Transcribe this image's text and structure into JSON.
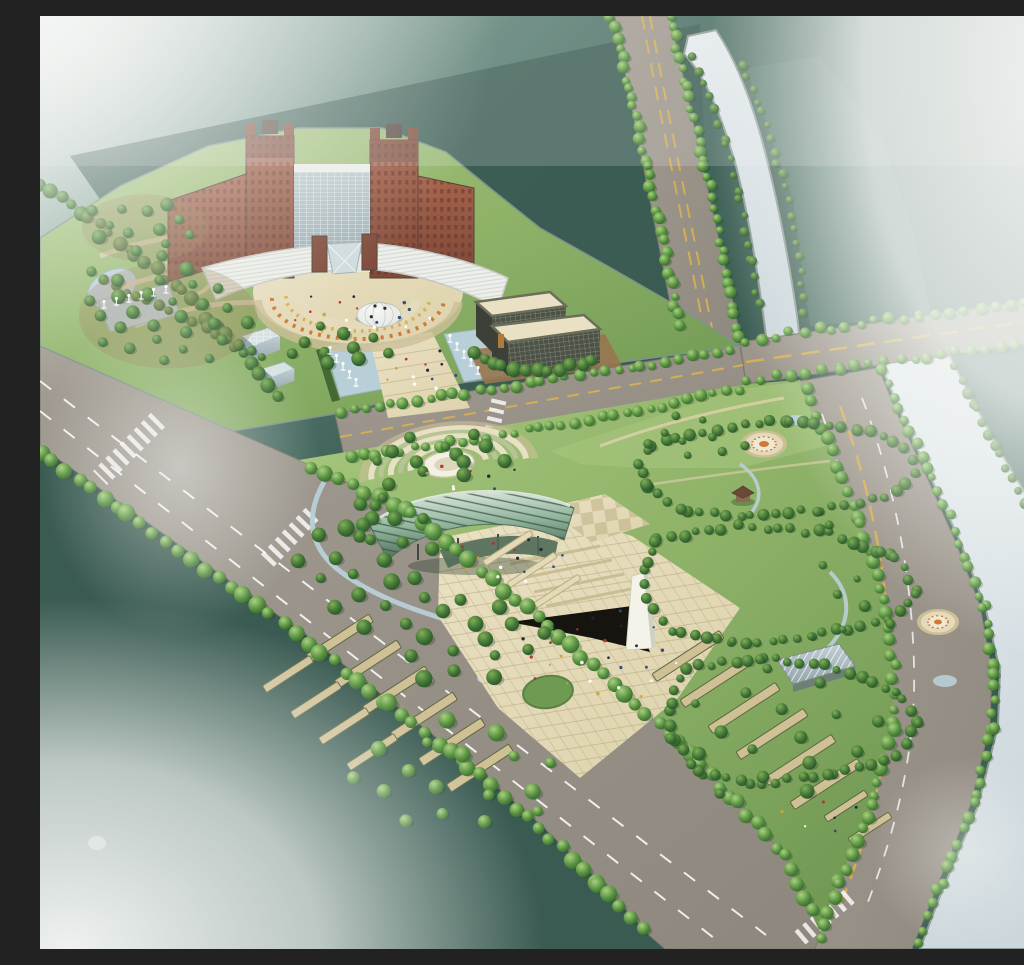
{
  "meta": {
    "width": 1024,
    "height": 933,
    "kind": "architectural-aerial-rendering"
  },
  "scene": {
    "description": "Bird's-eye rendering of a riverside civic campus with a red-brick high-rise, crescent forecourt with dome, office block, tree-lined roads, a bridge over a river, and a large memorial park with amphitheater canopy, obelisk plaza and lawns",
    "elements": [
      "main-building",
      "crescent-forecourt",
      "dome",
      "office-building",
      "glass-cubes",
      "fountain-channels",
      "north-avenue",
      "central-road",
      "boulevard",
      "bridge",
      "riverside-road",
      "river",
      "memorial-park",
      "amphitheater",
      "canopy-pavilion",
      "monument-obelisk",
      "circular-lawn",
      "greenhouse-pavilion",
      "garden-medallions",
      "gazebo",
      "streams",
      "tree-rows",
      "pedestrians"
    ]
  },
  "palette": {
    "bgTop": "#e9efec",
    "water": "#43665c",
    "waterDark": "#3a5b52",
    "farBank": "#4e7166",
    "river": "#ccd7dc",
    "riverLight": "#e7edf0",
    "bank": "#8d9b94",
    "road": "#a39c92",
    "roadDark": "#8f887e",
    "roadEdge": "#7e786e",
    "laneYellow": "#d2ae54",
    "laneWhite": "#ffffff",
    "lawn": "#8db167",
    "lawnDark": "#6d9551",
    "lawnLight": "#a8c67e",
    "plaza": "#ddd2ab",
    "plazaLight": "#eae1c4",
    "plazaLine": "#b7a77d",
    "stripTan": "#cfc096",
    "stripLight": "#e4dab6",
    "stripEdge": "#5c6840",
    "soil": "#987650",
    "brick": "#a8634b",
    "brickDark": "#7f4938",
    "roofDark": "#53423a",
    "white": "#eceee9",
    "roofGray": "#c6c9c4",
    "glass": "#c2cfd3",
    "glassDark": "#93a6ac",
    "curtain": "#4d5247",
    "curtainLine": "#c2c6b8",
    "dome": "#e8eae6",
    "domeShade": "#b9bfba",
    "canopy": "#8fb29a",
    "canopyDark": "#4f6a58",
    "canopyLight": "#e6eee7",
    "stream": "#b9cfd8",
    "obelisk": "#f4f3ea",
    "shadow": "#15140f",
    "treeShadow": "#1d3a22",
    "mist": "#f4f6f4",
    "treeBrightA": "#a9d17f",
    "treeBrightB": "#579140",
    "treeBrightC": "#2f5c2b",
    "treeDarkA": "#7fae58",
    "treeDarkB": "#417436",
    "treeDarkC": "#224a23",
    "people": [
      "#1e2430",
      "#ffffff",
      "#b03030",
      "#2a4a7a",
      "#caa23c"
    ]
  },
  "vegetation": {
    "rows": [
      {
        "name": "avenue-north-left",
        "points": [
          [
            571,
            0
          ],
          [
            589,
            70
          ],
          [
            607,
            150
          ],
          [
            625,
            235
          ],
          [
            641,
            318
          ]
        ],
        "step": 11,
        "r": 5,
        "variant": "bright"
      },
      {
        "name": "avenue-north-right",
        "points": [
          [
            629,
            0
          ],
          [
            647,
            70
          ],
          [
            665,
            150
          ],
          [
            683,
            235
          ],
          [
            699,
            322
          ]
        ],
        "step": 11,
        "r": 5,
        "variant": "bright"
      },
      {
        "name": "river-west-bank",
        "points": [
          [
            652,
            40
          ],
          [
            668,
            80
          ],
          [
            686,
            130
          ],
          [
            700,
            185
          ],
          [
            712,
            245
          ],
          [
            720,
            300
          ]
        ],
        "step": 15,
        "r": 4,
        "variant": "dark"
      },
      {
        "name": "river-east-bank",
        "points": [
          [
            702,
            50
          ],
          [
            722,
            95
          ],
          [
            738,
            145
          ],
          [
            750,
            200
          ],
          [
            760,
            255
          ],
          [
            766,
            305
          ]
        ],
        "step": 14,
        "r": 4,
        "variant": "dark"
      },
      {
        "name": "bridge-north",
        "points": [
          [
            706,
            324
          ],
          [
            790,
            312
          ],
          [
            880,
            300
          ],
          [
            970,
            288
          ],
          [
            1020,
            282
          ]
        ],
        "step": 15,
        "r": 5,
        "variant": "bright"
      },
      {
        "name": "bridge-south",
        "points": [
          [
            708,
            364
          ],
          [
            800,
            352
          ],
          [
            900,
            339
          ],
          [
            1000,
            326
          ],
          [
            1022,
            323
          ]
        ],
        "step": 15,
        "r": 5,
        "variant": "bright"
      },
      {
        "name": "central-road-north",
        "points": [
          [
            300,
            396
          ],
          [
            400,
            381
          ],
          [
            500,
            366
          ],
          [
            600,
            350
          ],
          [
            690,
            334
          ]
        ],
        "step": 13,
        "r": 5,
        "variant": "bright"
      },
      {
        "name": "central-road-south",
        "points": [
          [
            310,
            442
          ],
          [
            410,
            427
          ],
          [
            510,
            411
          ],
          [
            610,
            394
          ],
          [
            700,
            372
          ]
        ],
        "step": 13,
        "r": 5,
        "variant": "bright"
      },
      {
        "name": "campus-west-shore",
        "points": [
          [
            0,
            168
          ],
          [
            48,
            202
          ],
          [
            96,
            238
          ],
          [
            140,
            274
          ],
          [
            178,
            310
          ],
          [
            212,
            348
          ],
          [
            240,
            382
          ]
        ],
        "step": 13,
        "r": 6,
        "variant": "dark"
      },
      {
        "name": "park-southwest-edge",
        "points": [
          [
            270,
            452
          ],
          [
            372,
            496
          ],
          [
            440,
            554
          ],
          [
            508,
            610
          ],
          [
            574,
            668
          ],
          [
            638,
            728
          ],
          [
            698,
            786
          ],
          [
            744,
            840
          ],
          [
            778,
            906
          ]
        ],
        "step": 15,
        "r": 7,
        "variant": "bright"
      },
      {
        "name": "boulevard-waterside",
        "points": [
          [
            0,
            436
          ],
          [
            88,
            498
          ],
          [
            178,
            562
          ],
          [
            268,
            626
          ],
          [
            348,
            688
          ],
          [
            428,
            750
          ],
          [
            498,
            810
          ],
          [
            558,
            868
          ],
          [
            606,
            918
          ]
        ],
        "step": 16,
        "r": 7,
        "variant": "bright"
      },
      {
        "name": "riverside-road-west",
        "points": [
          [
            766,
            372
          ],
          [
            792,
            436
          ],
          [
            820,
            508
          ],
          [
            844,
            582
          ],
          [
            854,
            650
          ],
          [
            852,
            714
          ],
          [
            832,
            788
          ],
          [
            798,
            868
          ],
          [
            778,
            926
          ]
        ],
        "step": 14,
        "r": 6,
        "variant": "bright"
      },
      {
        "name": "riverside-road-east",
        "points": [
          [
            842,
            356
          ],
          [
            864,
            404
          ],
          [
            892,
            462
          ],
          [
            920,
            526
          ],
          [
            944,
            592
          ],
          [
            954,
            656
          ],
          [
            952,
            712
          ],
          [
            934,
            788
          ],
          [
            898,
            874
          ],
          [
            876,
            930
          ]
        ],
        "step": 14,
        "r": 5,
        "variant": "bright"
      },
      {
        "name": "far-bank-shore",
        "points": [
          [
            916,
            352
          ],
          [
            936,
            392
          ],
          [
            960,
            438
          ],
          [
            986,
            486
          ],
          [
            1010,
            530
          ]
        ],
        "step": 14,
        "r": 5,
        "variant": "dark"
      },
      {
        "name": "office-grove",
        "points": [
          [
            432,
            338
          ],
          [
            462,
            350
          ],
          [
            496,
            356
          ],
          [
            530,
            350
          ],
          [
            560,
            342
          ]
        ],
        "step": 12,
        "r": 6,
        "variant": "dark"
      },
      {
        "name": "lawn-loop-north",
        "points": [
          [
            612,
            428
          ],
          [
            680,
            412
          ],
          [
            750,
            404
          ],
          [
            818,
            412
          ],
          [
            866,
            432
          ],
          [
            876,
            458
          ],
          [
            844,
            482
          ],
          [
            776,
            494
          ],
          [
            700,
            502
          ],
          [
            640,
            494
          ],
          [
            604,
            470
          ],
          [
            600,
            446
          ],
          [
            612,
            428
          ]
        ],
        "step": 13,
        "r": 5,
        "variant": "dark"
      },
      {
        "name": "lawn-loop-central",
        "points": [
          [
            618,
            522
          ],
          [
            700,
            510
          ],
          [
            788,
            517
          ],
          [
            856,
            542
          ],
          [
            876,
            576
          ],
          [
            848,
            606
          ],
          [
            770,
            620
          ],
          [
            692,
            627
          ],
          [
            632,
            614
          ],
          [
            606,
            582
          ],
          [
            606,
            548
          ],
          [
            618,
            522
          ]
        ],
        "step": 13,
        "r": 5,
        "variant": "dark"
      },
      {
        "name": "lawn-loop-south",
        "points": [
          [
            644,
            652
          ],
          [
            722,
            642
          ],
          [
            798,
            652
          ],
          [
            856,
            674
          ],
          [
            880,
            706
          ],
          [
            856,
            740
          ],
          [
            788,
            760
          ],
          [
            712,
            768
          ],
          [
            658,
            756
          ],
          [
            630,
            722
          ],
          [
            630,
            688
          ],
          [
            644,
            652
          ]
        ],
        "step": 13,
        "r": 5,
        "variant": "dark"
      },
      {
        "name": "campus-garden-row",
        "points": [
          [
            52,
            258
          ],
          [
            96,
            280
          ],
          [
            142,
            302
          ],
          [
            188,
            324
          ],
          [
            232,
            346
          ]
        ],
        "step": 13,
        "r": 5,
        "variant": "dark"
      },
      {
        "name": "plaza-west-row",
        "points": [
          [
            350,
            470
          ],
          [
            330,
            500
          ],
          [
            316,
            532
          ]
        ],
        "step": 12,
        "r": 6,
        "variant": "dark"
      }
    ],
    "clumps": [
      {
        "name": "campus-left-garden",
        "cx": 128,
        "cy": 300,
        "rx": 85,
        "ry": 50,
        "n": 26,
        "r": 6,
        "variant": "dark",
        "soil": true
      },
      {
        "name": "campus-north-grove",
        "cx": 105,
        "cy": 212,
        "rx": 60,
        "ry": 32,
        "n": 13,
        "r": 6,
        "variant": "dark",
        "soil": true
      },
      {
        "name": "campus-east-grove",
        "cx": 300,
        "cy": 330,
        "rx": 55,
        "ry": 25,
        "n": 10,
        "r": 6,
        "variant": "dark",
        "soil": false
      },
      {
        "name": "park-west-hill",
        "cx": 330,
        "cy": 545,
        "rx": 75,
        "ry": 65,
        "n": 20,
        "r": 7,
        "variant": "dark",
        "soil": false
      },
      {
        "name": "stream-grove",
        "cx": 430,
        "cy": 625,
        "rx": 85,
        "ry": 45,
        "n": 16,
        "r": 7,
        "variant": "dark",
        "soil": false
      },
      {
        "name": "terrace-grove",
        "cx": 420,
        "cy": 760,
        "rx": 110,
        "ry": 60,
        "n": 18,
        "r": 7,
        "variant": "bright",
        "soil": false
      },
      {
        "name": "east-terrace-grove",
        "cx": 740,
        "cy": 720,
        "rx": 110,
        "ry": 70,
        "n": 16,
        "r": 6,
        "variant": "dark",
        "soil": false
      },
      {
        "name": "bridgehead-garden",
        "cx": 660,
        "cy": 420,
        "rx": 55,
        "ry": 28,
        "n": 10,
        "r": 5,
        "variant": "dark",
        "soil": false
      },
      {
        "name": "canopy-back-grove",
        "cx": 400,
        "cy": 438,
        "rx": 80,
        "ry": 22,
        "n": 12,
        "r": 6,
        "variant": "dark",
        "soil": false
      },
      {
        "name": "southeast-corner-grove",
        "cx": 810,
        "cy": 560,
        "rx": 40,
        "ry": 60,
        "n": 8,
        "r": 5,
        "variant": "dark",
        "soil": false
      }
    ]
  },
  "planting_strips": [
    {
      "x": 468,
      "y": 532,
      "len": 56,
      "th": 6,
      "angle": -33,
      "tone": "light"
    },
    {
      "x": 492,
      "y": 554,
      "len": 56,
      "th": 6,
      "angle": -33,
      "tone": "light"
    },
    {
      "x": 516,
      "y": 576,
      "len": 56,
      "th": 6,
      "angle": -33,
      "tone": "light"
    },
    {
      "x": 300,
      "y": 622,
      "len": 74,
      "th": 9,
      "angle": -33,
      "tone": "tan"
    },
    {
      "x": 328,
      "y": 648,
      "len": 74,
      "th": 9,
      "angle": -33,
      "tone": "tan"
    },
    {
      "x": 356,
      "y": 674,
      "len": 74,
      "th": 9,
      "angle": -33,
      "tone": "tan"
    },
    {
      "x": 384,
      "y": 700,
      "len": 74,
      "th": 9,
      "angle": -33,
      "tone": "tan"
    },
    {
      "x": 412,
      "y": 726,
      "len": 74,
      "th": 9,
      "angle": -33,
      "tone": "tan"
    },
    {
      "x": 440,
      "y": 752,
      "len": 74,
      "th": 9,
      "angle": -33,
      "tone": "tan"
    },
    {
      "x": 248,
      "y": 658,
      "len": 56,
      "th": 8,
      "angle": -33,
      "tone": "tan"
    },
    {
      "x": 276,
      "y": 684,
      "len": 56,
      "th": 8,
      "angle": -33,
      "tone": "tan"
    },
    {
      "x": 304,
      "y": 710,
      "len": 56,
      "th": 8,
      "angle": -33,
      "tone": "tan"
    },
    {
      "x": 332,
      "y": 736,
      "len": 56,
      "th": 8,
      "angle": -33,
      "tone": "tan"
    },
    {
      "x": 648,
      "y": 640,
      "len": 80,
      "th": 9,
      "angle": -33,
      "tone": "tan"
    },
    {
      "x": 676,
      "y": 666,
      "len": 80,
      "th": 9,
      "angle": -33,
      "tone": "tan"
    },
    {
      "x": 704,
      "y": 692,
      "len": 80,
      "th": 9,
      "angle": -33,
      "tone": "tan"
    },
    {
      "x": 732,
      "y": 718,
      "len": 80,
      "th": 9,
      "angle": -33,
      "tone": "tan"
    },
    {
      "x": 760,
      "y": 744,
      "len": 80,
      "th": 9,
      "angle": -33,
      "tone": "tan"
    },
    {
      "x": 786,
      "y": 768,
      "len": 80,
      "th": 9,
      "angle": -33,
      "tone": "tan"
    },
    {
      "x": 806,
      "y": 790,
      "len": 48,
      "th": 7,
      "angle": -33,
      "tone": "tan"
    },
    {
      "x": 830,
      "y": 812,
      "len": 48,
      "th": 7,
      "angle": -33,
      "tone": "tan"
    }
  ],
  "people_groups": [
    {
      "name": "crescent-plaza-visitors",
      "cx": 318,
      "cy": 300,
      "rx": 70,
      "ry": 22,
      "n": 22
    },
    {
      "name": "axis-walk-visitors",
      "cx": 382,
      "cy": 355,
      "rx": 38,
      "ry": 22,
      "n": 12
    },
    {
      "name": "monument-plaza-visitors",
      "cx": 560,
      "cy": 640,
      "rx": 85,
      "ry": 48,
      "n": 26
    },
    {
      "name": "canopy-plaza-visitors",
      "cx": 470,
      "cy": 545,
      "rx": 55,
      "ry": 28,
      "n": 14
    },
    {
      "name": "amphitheater-visitors",
      "cx": 430,
      "cy": 462,
      "rx": 60,
      "ry": 16,
      "n": 8
    },
    {
      "name": "east-path-visitors",
      "cx": 780,
      "cy": 800,
      "rx": 40,
      "ry": 20,
      "n": 6
    }
  ],
  "fountain_jets": [
    {
      "x1": 290,
      "y1": 338,
      "x2": 316,
      "y2": 370,
      "n": 5
    },
    {
      "x1": 410,
      "y1": 326,
      "x2": 438,
      "y2": 358,
      "n": 5
    },
    {
      "x1": 64,
      "y1": 292,
      "x2": 126,
      "y2": 277,
      "n": 6
    }
  ]
}
